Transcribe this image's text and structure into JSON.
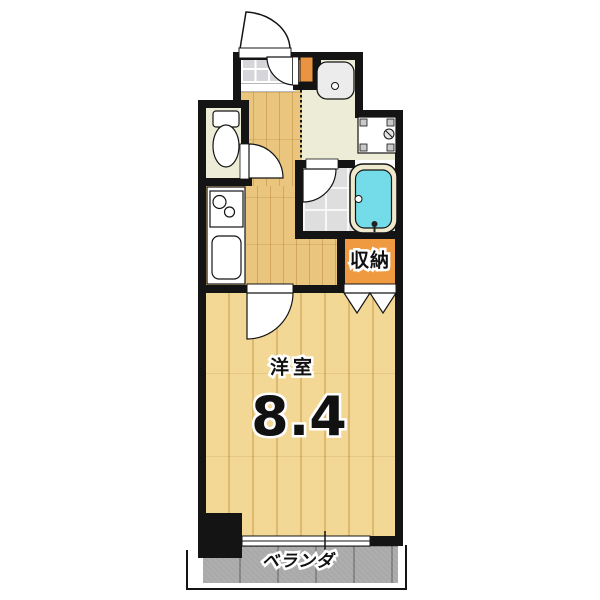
{
  "plan": {
    "rooms": {
      "main": {
        "label": "洋室",
        "size": "8.4"
      },
      "storage": {
        "label": "収納"
      },
      "balcony": {
        "label": "ベランダ"
      }
    },
    "colors": {
      "wall": "#141414",
      "hall_wood": "#eac57d",
      "main_room_wood": "#f2d795",
      "storage_orange": "#ef9a41",
      "shoe_cabinet_orange": "#ea9340",
      "bathtub_blue": "#74dbe8",
      "bathtub_rim_cream": "#efe9cd",
      "balcony_gray": "#a9a9a9",
      "entrance_tile_gray": "#d6d6da",
      "bathroom_tile_gray": "#dedede",
      "washroom_floor_cream": "#edecd6"
    },
    "fixtures": [
      "entry-door",
      "shoe-cabinet",
      "washbasin",
      "washing-machine-pan",
      "toilet",
      "kitchen-stove",
      "kitchen-sink",
      "bathtub",
      "folding-closet-door",
      "window",
      "pillar"
    ]
  }
}
